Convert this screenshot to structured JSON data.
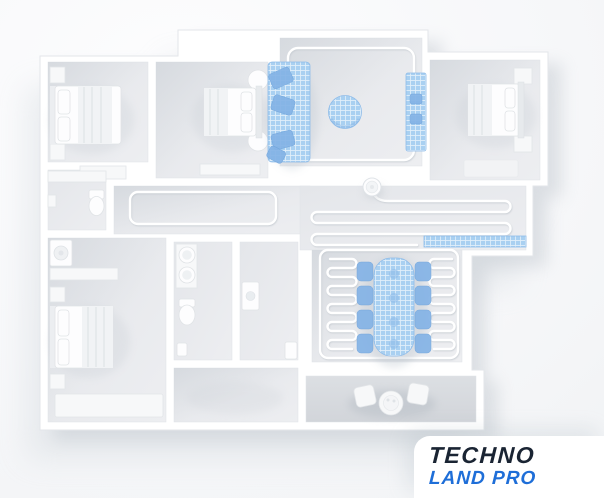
{
  "meta": {
    "scene_description": "3D top-view apartment floor plan with highlighted blue zones and robot vacuum cleaning route"
  },
  "brand": {
    "line1": "TECHNO",
    "line2": "LAND PRO"
  },
  "colors": {
    "logo_navy": "#1a2433",
    "logo_blue": "#1e6ed8",
    "highlight_blue": "#a9d0f1",
    "highlight_blue_dark": "#84b3e6",
    "floor_gray": "#e8eaed",
    "wall_white": "#ffffff",
    "balcony_gray": "#d9dce0"
  }
}
